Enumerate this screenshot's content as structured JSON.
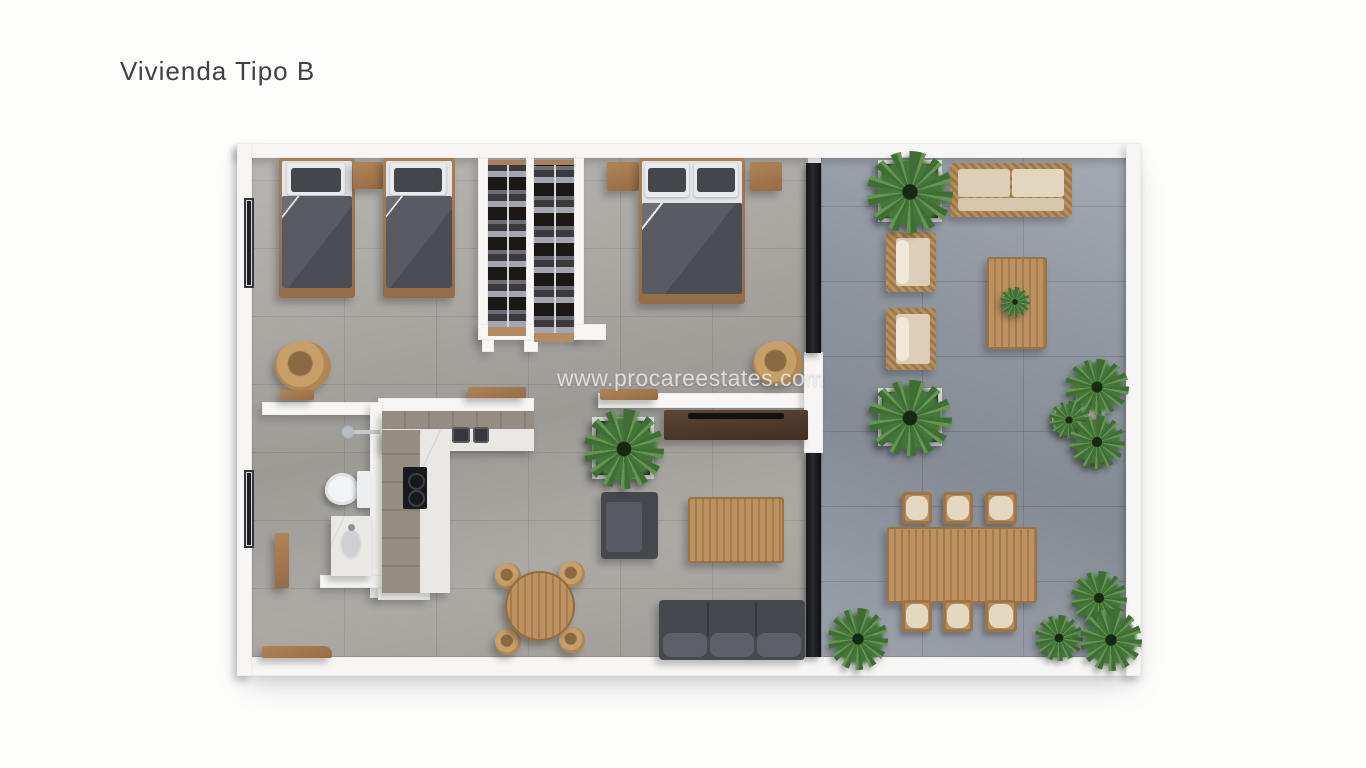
{
  "title": {
    "text": "Vivienda Tipo B",
    "color": "#404145"
  },
  "watermark": {
    "text": "www.procareestates.com"
  },
  "plan": {
    "colors": {
      "wall": "#f7f6f4",
      "indoor_floor": "#a6a39e",
      "terrace_floor": "#9098a1",
      "dark_fabric": "#4d5156",
      "bed_wood": "#a87e55",
      "teak": "#b78d5b",
      "rattan": "#c7a069",
      "marble": "#eae8e5",
      "cushion_beige": "#ddcfb7",
      "plant_green": "#4e7c3e",
      "glass_frame": "#1c1f23"
    },
    "rooms": [
      {
        "name": "bedroom-twin",
        "furniture": [
          "single-bed",
          "single-bed",
          "nightstand",
          "rattan-chair",
          "window"
        ]
      },
      {
        "name": "walk-in-closet",
        "furniture": [
          "wardrobe-column",
          "wardrobe-column"
        ]
      },
      {
        "name": "bedroom-master",
        "furniture": [
          "double-bed",
          "nightstand",
          "nightstand",
          "rattan-chair",
          "sliding-glass-door"
        ]
      },
      {
        "name": "bathroom",
        "furniture": [
          "toilet",
          "sink-counter",
          "shower-head",
          "window",
          "door-leaf"
        ]
      },
      {
        "name": "kitchen",
        "furniture": [
          "l-shaped-counter",
          "double-sink",
          "cooktop"
        ]
      },
      {
        "name": "living-dining",
        "furniture": [
          "tv-console",
          "planter",
          "armchair",
          "coffee-table",
          "sofa",
          "round-dining-table",
          "four-chairs",
          "wall-shelf",
          "wall-shelf",
          "bench"
        ]
      },
      {
        "name": "terrace",
        "furniture": [
          "outdoor-sofa",
          "outdoor-armchair",
          "outdoor-armchair",
          "outdoor-coffee-table",
          "planter-box",
          "planter-box",
          "outdoor-dining-table",
          "six-outdoor-chairs",
          "potted-plants"
        ]
      }
    ]
  }
}
